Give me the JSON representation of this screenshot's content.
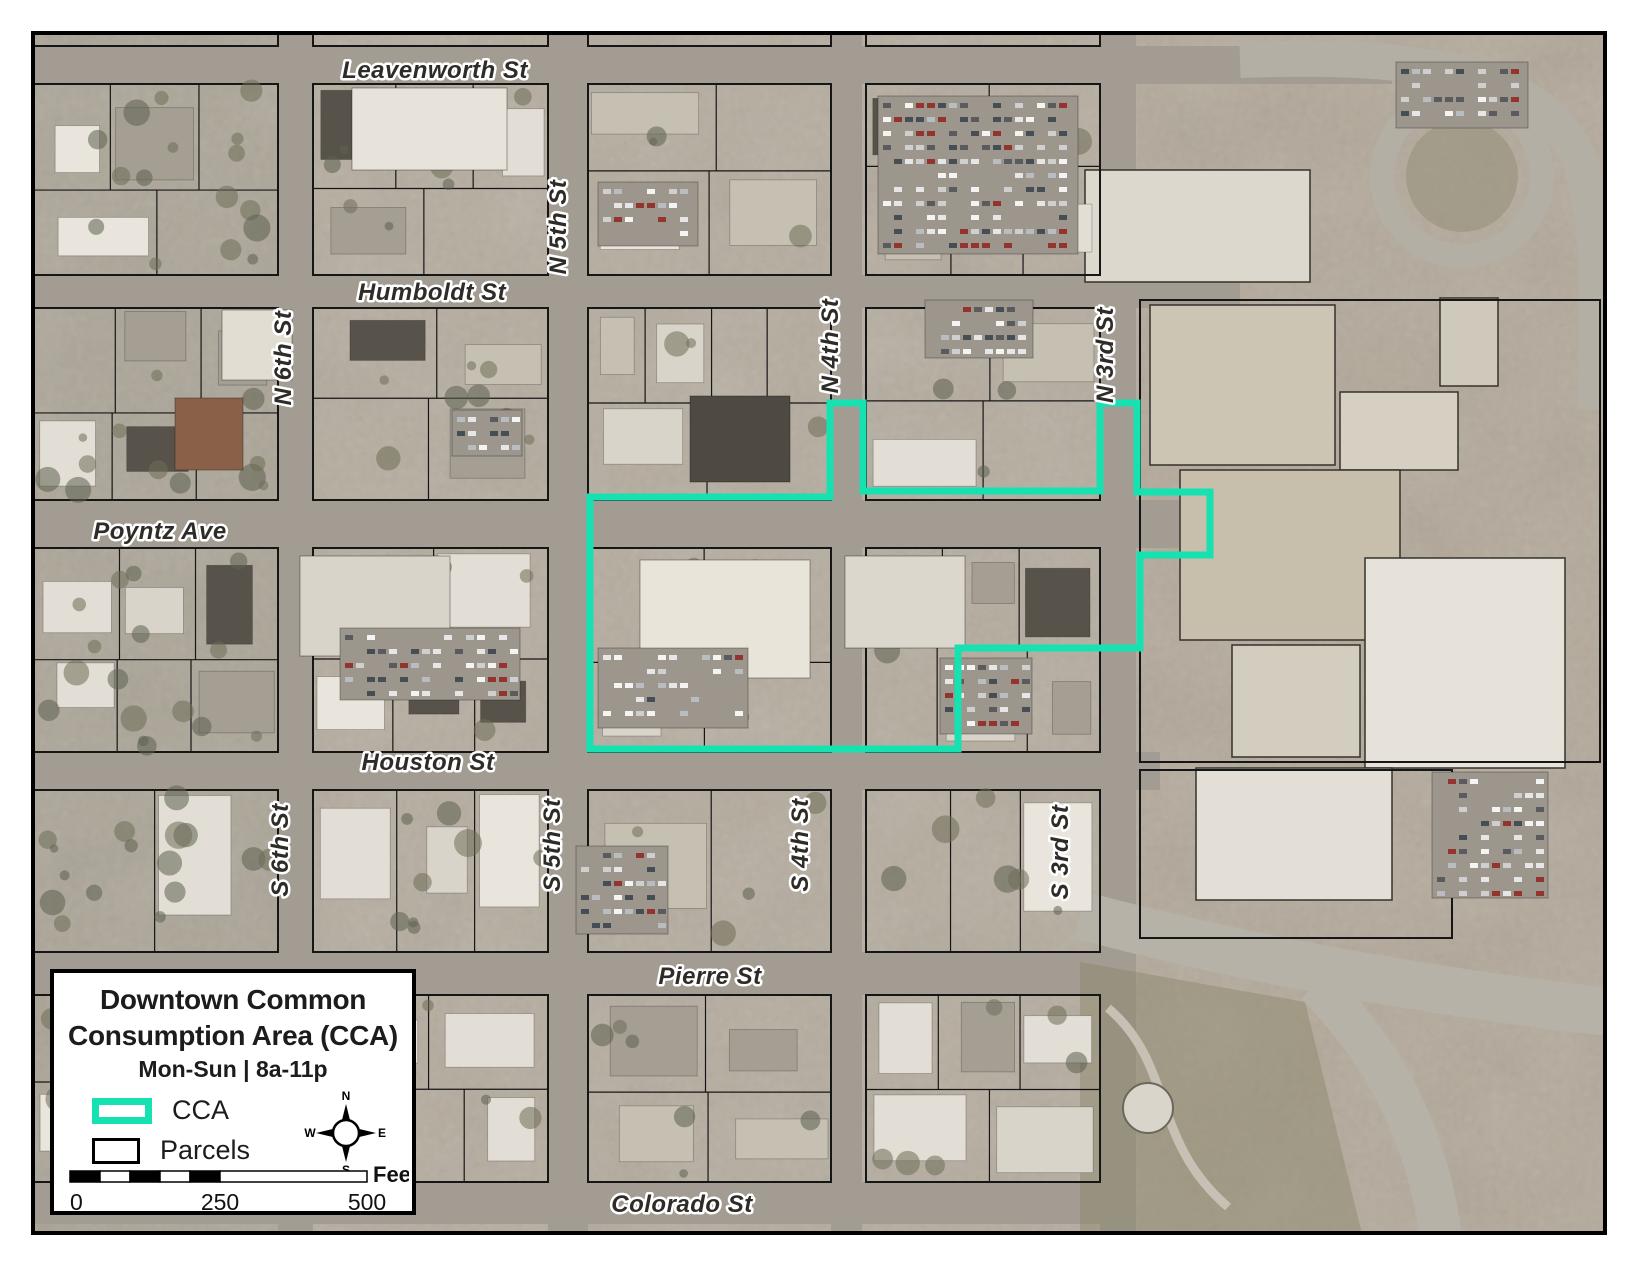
{
  "legend": {
    "title_line1": "Downtown Common",
    "title_line2": "Consumption Area (CCA)",
    "hours": "Mon-Sun | 8a-11p",
    "items": [
      {
        "label": "CCA",
        "color": "#15E2B0"
      },
      {
        "label": "Parcels",
        "color": "#000000"
      }
    ],
    "compass": {
      "n": "N",
      "e": "E",
      "s": "S",
      "w": "W"
    },
    "scalebar": {
      "ticks": [
        "0",
        "250",
        "500"
      ],
      "unit": "Feet"
    }
  },
  "map": {
    "cca": {
      "label": "CCA",
      "color": "#15E2B0",
      "points": [
        [
          590,
          497
        ],
        [
          830,
          497
        ],
        [
          830,
          403
        ],
        [
          863,
          403
        ],
        [
          863,
          491
        ],
        [
          1100,
          491
        ],
        [
          1100,
          403
        ],
        [
          1137,
          403
        ],
        [
          1137,
          492
        ],
        [
          1210,
          492
        ],
        [
          1210,
          555
        ],
        [
          1140,
          555
        ],
        [
          1140,
          648
        ],
        [
          958,
          648
        ],
        [
          958,
          749
        ],
        [
          590,
          749
        ]
      ]
    },
    "street_labels": [
      {
        "text": "Leavenworth St",
        "x": 435,
        "y": 78,
        "rot": 0
      },
      {
        "text": "Humboldt St",
        "x": 432,
        "y": 300,
        "rot": 0
      },
      {
        "text": "Poyntz Ave",
        "x": 160,
        "y": 539,
        "rot": 0
      },
      {
        "text": "Houston St",
        "x": 428,
        "y": 770,
        "rot": 0
      },
      {
        "text": "Pierre St",
        "x": 710,
        "y": 984,
        "rot": 0
      },
      {
        "text": "Colorado St",
        "x": 682,
        "y": 1212,
        "rot": 0
      },
      {
        "text": "N 6th St",
        "x": 291,
        "y": 358,
        "rot": -90
      },
      {
        "text": "N 5th St",
        "x": 566,
        "y": 227,
        "rot": -90
      },
      {
        "text": "N 4th St",
        "x": 838,
        "y": 346,
        "rot": -90
      },
      {
        "text": "N 3rd St",
        "x": 1113,
        "y": 355,
        "rot": -90
      },
      {
        "text": "S 6th St",
        "x": 288,
        "y": 850,
        "rot": -90
      },
      {
        "text": "S 5th St",
        "x": 560,
        "y": 845,
        "rot": -90
      },
      {
        "text": "S 4th St",
        "x": 808,
        "y": 845,
        "rot": -90
      },
      {
        "text": "S 3rd St",
        "x": 1068,
        "y": 852,
        "rot": -90
      }
    ]
  }
}
